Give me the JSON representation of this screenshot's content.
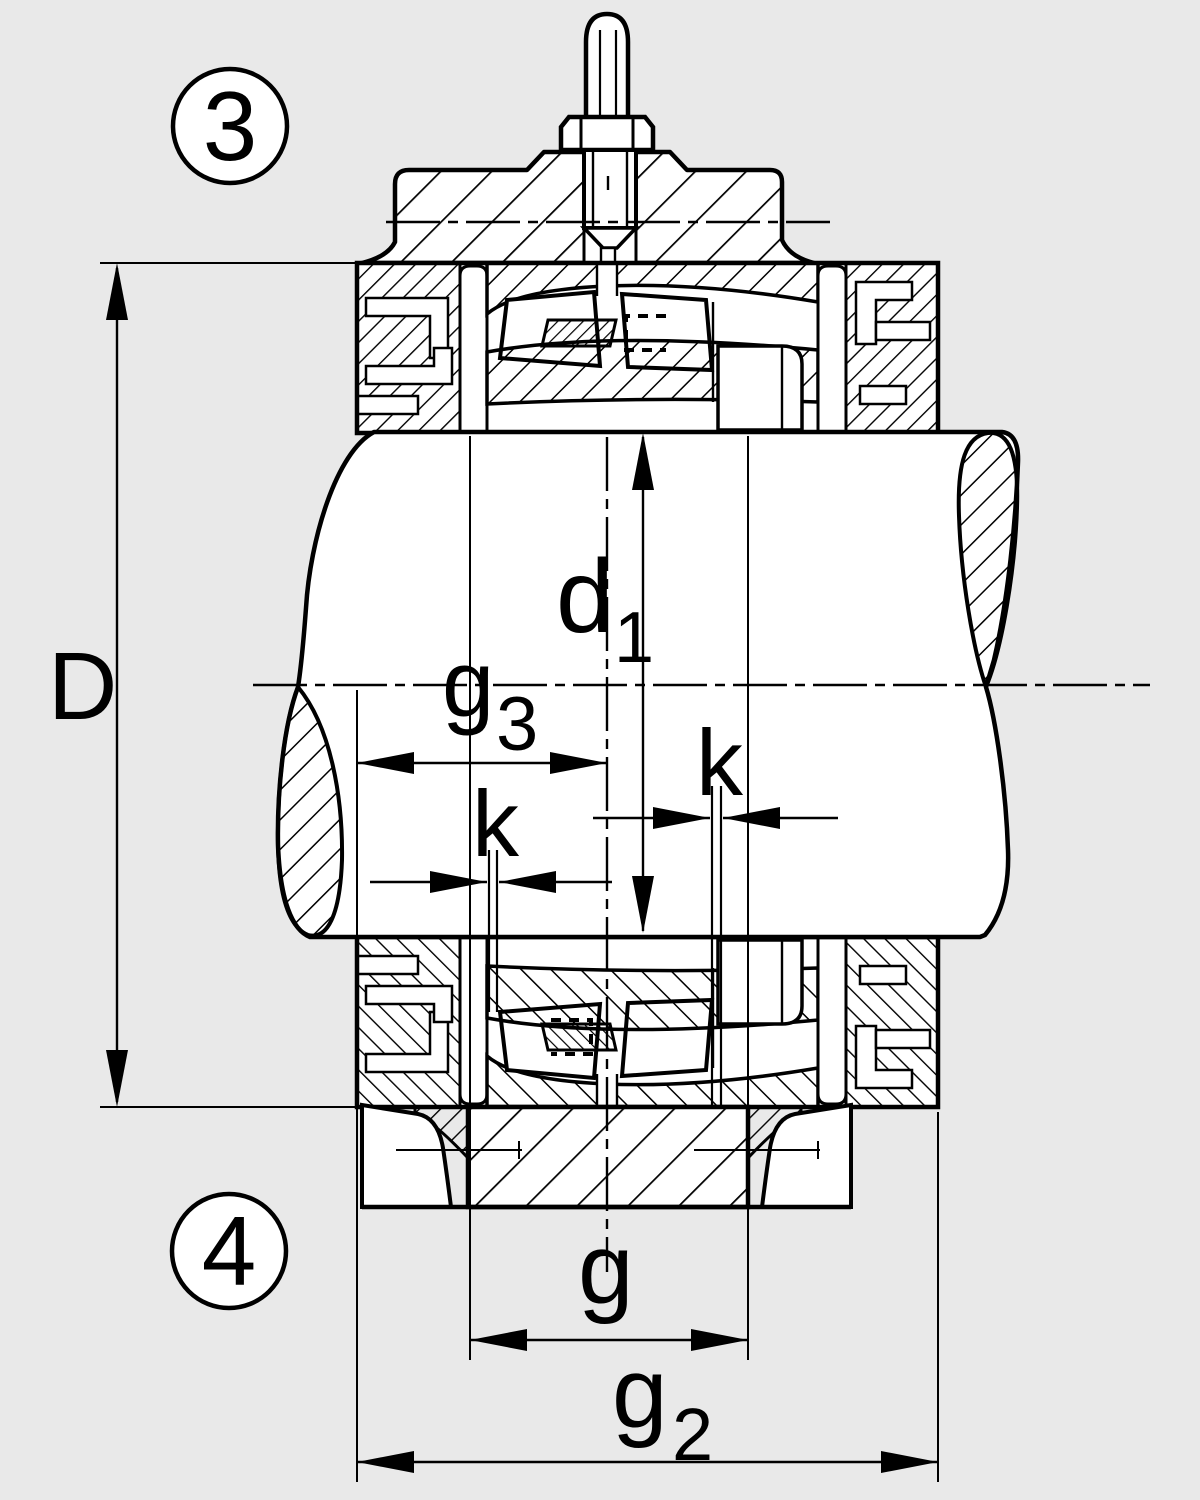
{
  "figure": {
    "type": "technical-section-drawing",
    "subject": "split plummer block housing with spherical roller bearing, shaft and grease nipple, cross-section",
    "background_color": "#e9e9e9",
    "line_color": "#000000",
    "fill_color": "#ffffff"
  },
  "callouts": {
    "top": "3",
    "bottom": "4"
  },
  "dimensions": {
    "D": "D",
    "d1_main": "d",
    "d1_sub": "1",
    "g3_main": "g",
    "g3_sub": "3",
    "k_left": "k",
    "k_right": "k",
    "g": "g",
    "g2_main": "g",
    "g2_sub": "2"
  }
}
